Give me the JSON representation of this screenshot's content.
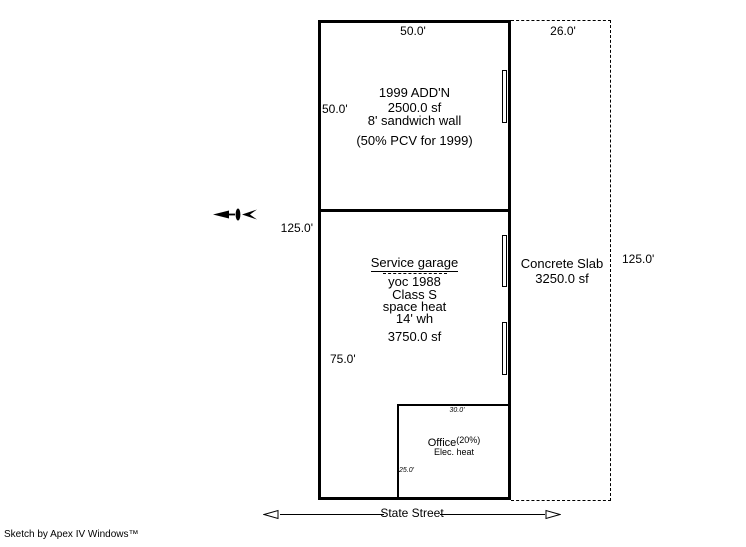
{
  "addition": {
    "dim_top": "50.0'",
    "dim_left": "50.0'",
    "name": "1999 ADD'N",
    "area": "2500.0 sf",
    "wall": "8' sandwich wall",
    "pcv": "(50% PCV for 1999)"
  },
  "garage": {
    "dim_left_total": "125.0'",
    "name": "Service garage",
    "yoc": "yoc 1988",
    "building_class": "Class S",
    "heat": "space heat",
    "wall_height": "14' wh",
    "area": "3750.0 sf",
    "dim_left": "75.0'"
  },
  "slab": {
    "dim_top": "26.0'",
    "name": "Concrete Slab",
    "area": "3250.0 sf",
    "dim_right": "125.0'"
  },
  "office": {
    "dim_top": "30.0'",
    "name": "Office",
    "pct": "(20%)",
    "heat": "Elec. heat",
    "dim_left": "25.0'"
  },
  "street": {
    "name": "State Street"
  },
  "footer": {
    "credit": "Sketch by Apex IV Windows™"
  },
  "colors": {
    "line": "#000000",
    "background": "#ffffff"
  }
}
